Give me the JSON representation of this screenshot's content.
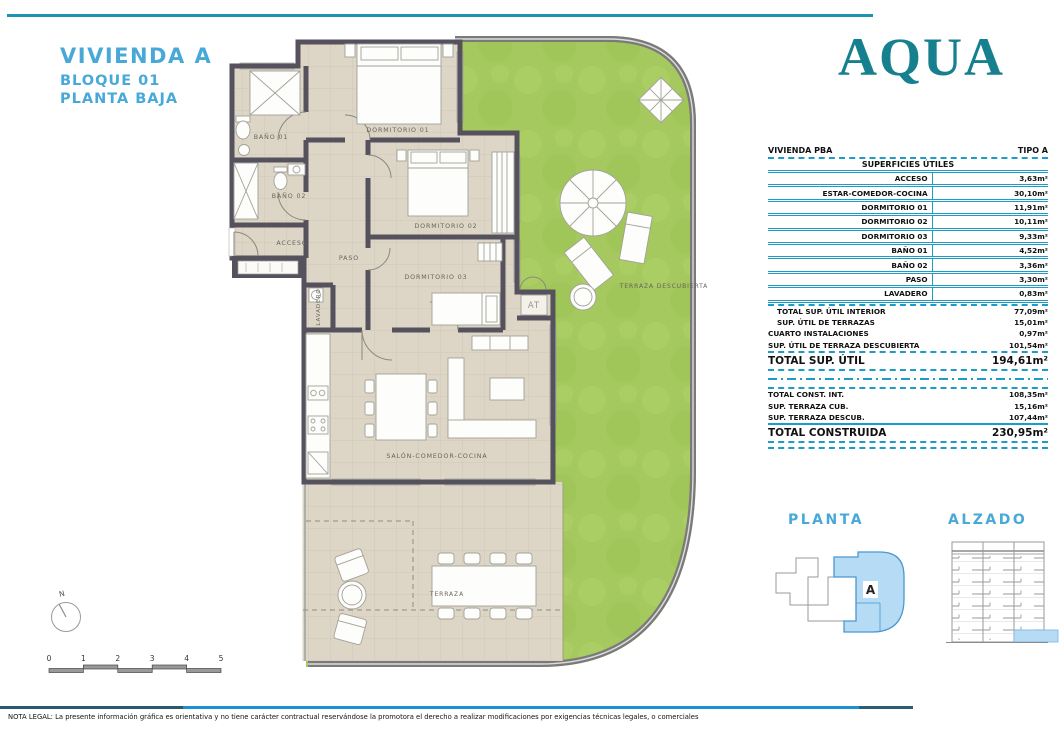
{
  "header": {
    "title": "VIVIENDA A",
    "subtitle_block": "BLOQUE 01",
    "subtitle_floor": "PLANTA BAJA"
  },
  "brand": {
    "logo_text": "AQUA"
  },
  "areas_table": {
    "header_left": "VIVIENDA PBA",
    "header_right": "TIPO A",
    "section_title": "SUPERFICIES ÚTILES",
    "rooms": [
      {
        "label": "ACCESO",
        "value": "3,63m²"
      },
      {
        "label": "ESTAR-COMEDOR-COCINA",
        "value": "30,10m²"
      },
      {
        "label": "DORMITORIO 01",
        "value": "11,91m²"
      },
      {
        "label": "DORMITORIO 02",
        "value": "10,11m²"
      },
      {
        "label": "DORMITORIO 03",
        "value": "9,33m²"
      },
      {
        "label": "BAÑO 01",
        "value": "4,52m²"
      },
      {
        "label": "BAÑO 02",
        "value": "3,36m²"
      },
      {
        "label": "PASO",
        "value": "3,30m²"
      },
      {
        "label": "LAVADERO",
        "value": "0,83m²"
      }
    ],
    "subtotals": [
      {
        "label": "TOTAL SUP. ÚTIL INTERIOR",
        "value": "77,09m²"
      },
      {
        "label": "SUP. ÚTIL DE TERRAZAS",
        "value": "15,01m²"
      },
      {
        "label": "CUARTO INSTALACIONES",
        "value": "0,97m²"
      },
      {
        "label": "SUP. ÚTIL DE TERRAZA DESCUBIERTA",
        "value": "101,54m²"
      }
    ],
    "total_util": {
      "label": "TOTAL SUP. ÚTIL",
      "value": "194,61m²"
    },
    "built": [
      {
        "label": "TOTAL CONST. INT.",
        "value": "108,35m²"
      },
      {
        "label": "SUP. TERRAZA CUB.",
        "value": "15,16m²"
      },
      {
        "label": "SUP. TERRAZA DESCUB.",
        "value": "107,44m²"
      }
    ],
    "total_built": {
      "label": "TOTAL CONSTRUIDA",
      "value": "230,95m²"
    }
  },
  "floor_plan": {
    "labels": {
      "bano01": "BAÑO 01",
      "bano02": "BAÑO 02",
      "acceso": "ACCESO",
      "paso": "PASO",
      "dorm01": "DORMITORIO 01",
      "dorm02": "DORMITORIO 02",
      "dorm03": "DORMITORIO 03",
      "lavadero": "LAVADERO",
      "salon": "SALÓN-COMEDOR-COCINA",
      "terraza": "TERRAZA",
      "terraza_descubierta": "TERRAZA DESCUBIERTA",
      "at": "AT"
    }
  },
  "mini_diagrams": {
    "planta_title": "PLANTA",
    "alzado_title": "ALZADO",
    "unit_letter": "A"
  },
  "compass": {
    "north": "N"
  },
  "scale_bar": {
    "ticks": [
      "0",
      "1",
      "2",
      "3",
      "4",
      "5"
    ]
  },
  "footer": {
    "legal_note": "NOTA LEGAL: La presente información gráfica es orientativa y no tiene carácter contractual reservándose la promotora el derecho a realizar modificaciones por exigencias técnicas legales, o comerciales"
  },
  "colors": {
    "accent_blue": "#48a9d9",
    "brand_teal": "#17808f",
    "table_line_teal": "#1e9cc8",
    "grass_green": "#a5c95e",
    "floor_beige": "#ddd5c6",
    "wall_dark": "#55525e",
    "unit_highlight": "#b5dbf5",
    "rule_blue": "#1b90d2"
  }
}
